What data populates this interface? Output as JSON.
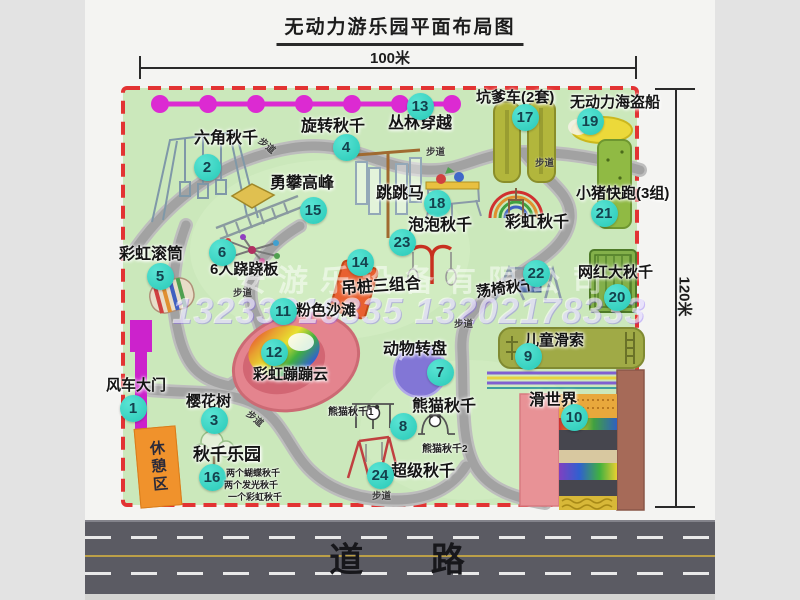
{
  "title": "无动力游乐园平面布局图",
  "dimensions": {
    "top": "100米",
    "right": "120米"
  },
  "road": {
    "label": "道 路"
  },
  "watermark": {
    "line1": "安游乐设备有限公司",
    "line2": "13233816335 13202178333"
  },
  "rest_area_label": "休憩区",
  "walkway_label": "步道",
  "attractions": [
    {
      "id": "windmill-gate",
      "num": "1",
      "label": "风车大门"
    },
    {
      "id": "hex-swing",
      "num": "2",
      "label": "六角秋千"
    },
    {
      "id": "cherry-tree",
      "num": "3",
      "label": "樱花树"
    },
    {
      "id": "rotate-swing",
      "num": "4",
      "label": "旋转秋千"
    },
    {
      "id": "rainbow-roller",
      "num": "5",
      "label": "彩虹滚筒"
    },
    {
      "id": "seesaw-6p",
      "num": "6",
      "label": "6人跷跷板"
    },
    {
      "id": "animal-turntable",
      "num": "7",
      "label": "动物转盘"
    },
    {
      "id": "panda-swing",
      "num": "8",
      "label": "熊猫秋千"
    },
    {
      "id": "kids-zipline",
      "num": "9",
      "label": "儿童滑索"
    },
    {
      "id": "slide-world",
      "num": "10",
      "label": "滑世界"
    },
    {
      "id": "pink-beach",
      "num": "11",
      "label": "粉色沙滩"
    },
    {
      "id": "rainbow-cloud",
      "num": "12",
      "label": "彩虹蹦蹦云"
    },
    {
      "id": "jungle-crossing",
      "num": "13",
      "label": "丛林穿越"
    },
    {
      "id": "hanging-post-combo",
      "num": "14",
      "label": "吊桩三组合"
    },
    {
      "id": "climb-peak",
      "num": "15",
      "label": "勇攀高峰"
    },
    {
      "id": "swing-park",
      "num": "16",
      "label": "秋千乐园"
    },
    {
      "id": "pit-car",
      "num": "17",
      "label": "坑爹车(2套)"
    },
    {
      "id": "jump-horse",
      "num": "18",
      "label": "跳跳马"
    },
    {
      "id": "pirate-ship",
      "num": "19",
      "label": "无动力海盗船"
    },
    {
      "id": "big-swing",
      "num": "20",
      "label": "网红大秋千"
    },
    {
      "id": "pig-run",
      "num": "21",
      "label": "小猪快跑(3组)"
    },
    {
      "id": "chair-swing",
      "num": "22",
      "label": "荡椅秋千"
    },
    {
      "id": "bubble-swing",
      "num": "23",
      "label": "泡泡秋千"
    },
    {
      "id": "super-swing",
      "num": "24",
      "label": "超级秋千"
    },
    {
      "id": "rainbow-swing",
      "num": "",
      "label": "彩虹秋千"
    }
  ],
  "sub_labels": [
    {
      "id": "panda-swing-1",
      "label": "熊猫秋千1"
    },
    {
      "id": "panda-swing-2",
      "label": "熊猫秋千2"
    },
    {
      "id": "swing-park-note-1",
      "label": "两个蝴蝶秋千"
    },
    {
      "id": "swing-park-note-2",
      "label": "两个发光秋千"
    },
    {
      "id": "swing-park-note-3",
      "label": "一个彩虹秋千"
    }
  ],
  "colors": {
    "badge": "#35d6c5",
    "boundary_red": "#e23333",
    "park_green": "#cbe8bb",
    "road_gray": "#5b5b63",
    "gate_magenta": "#cc22cc",
    "chain_magenta": "#dc2ad2"
  }
}
